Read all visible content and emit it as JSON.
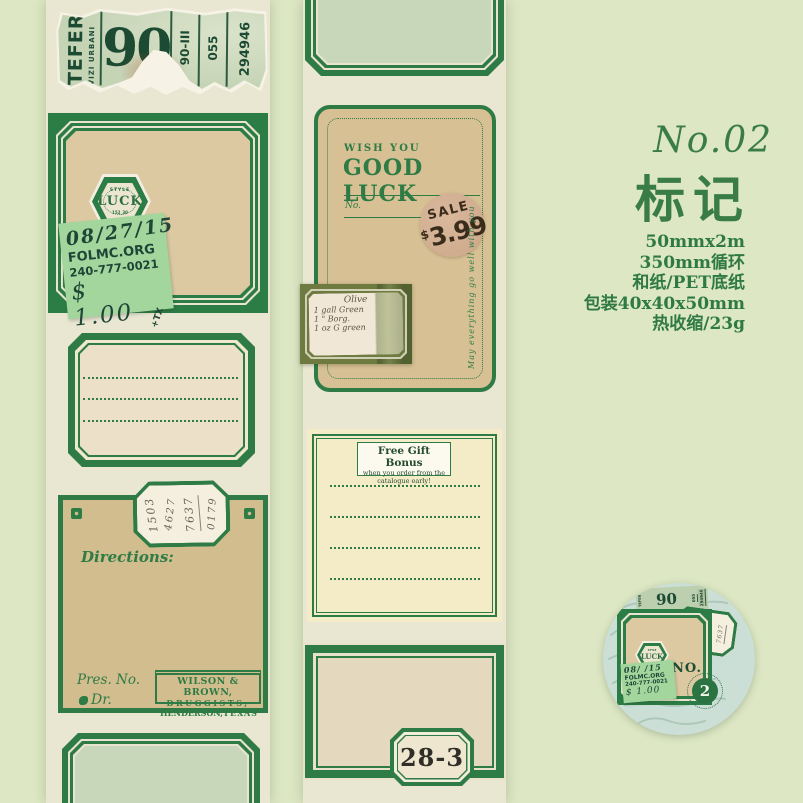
{
  "colors": {
    "accent_green": "#2e7b45",
    "page_bg": "#dde7c4",
    "tape_bg": "#e9e6d2"
  },
  "right_panel": {
    "series_no": "No.02",
    "title": "标记",
    "specs": [
      "50mmx2m",
      "350mm循环",
      "和纸/PET底纸",
      "包装40x40x50mm",
      "热收缩/23g"
    ]
  },
  "ticket": {
    "brand": "TEFER",
    "brand_sub": "VIZI URBANI",
    "big_number": "90",
    "serial_1": "90-III",
    "serial_2": "055",
    "serial_3": "294946"
  },
  "luck_label": {
    "hex_top": "STYLE",
    "hex_word": "LUCK",
    "hex_code": "152_30",
    "sticker_date": "08/27/15",
    "sticker_org": "FOLMC.ORG",
    "sticker_phone": "240-777-0021",
    "sticker_price": "$ 1.00",
    "sticker_tax": "+TX"
  },
  "goodluck_tag": {
    "wish": "WISH YOU",
    "greeting": "GOOD LUCK",
    "no_label": "No.",
    "sale_word": "SALE",
    "sale_price": "$3.99",
    "side_text": "May everything go well with you",
    "note_title": "Olive",
    "note_line1": "1 gall Green",
    "note_line2": "1 \" Borg.",
    "note_line3": "1 oz G green"
  },
  "free_gift": {
    "title": "Free Gift Bonus",
    "sub1": "when you order from the",
    "sub2": "catalogue early!"
  },
  "directions_label": {
    "directions": "Directions:",
    "pres_no": "Pres. No.",
    "dr": "Dr.",
    "tab_numbers": [
      "1503",
      "4627",
      "7637",
      "0179"
    ],
    "pharmacy_name": "WILSON & BROWN,",
    "pharmacy_type": "DRUGGISTS,",
    "pharmacy_city": "HENDERSON,",
    "pharmacy_state": "TEXAS"
  },
  "frame_label": {
    "tab_number": "28-3"
  },
  "badge": {
    "no_text": "NO.",
    "number": "2",
    "sticker_date": "08/ /15",
    "sticker_org": "FOLMC.ORG",
    "sticker_phone": "240-777-0021",
    "sticker_price": "$ 1.00"
  }
}
